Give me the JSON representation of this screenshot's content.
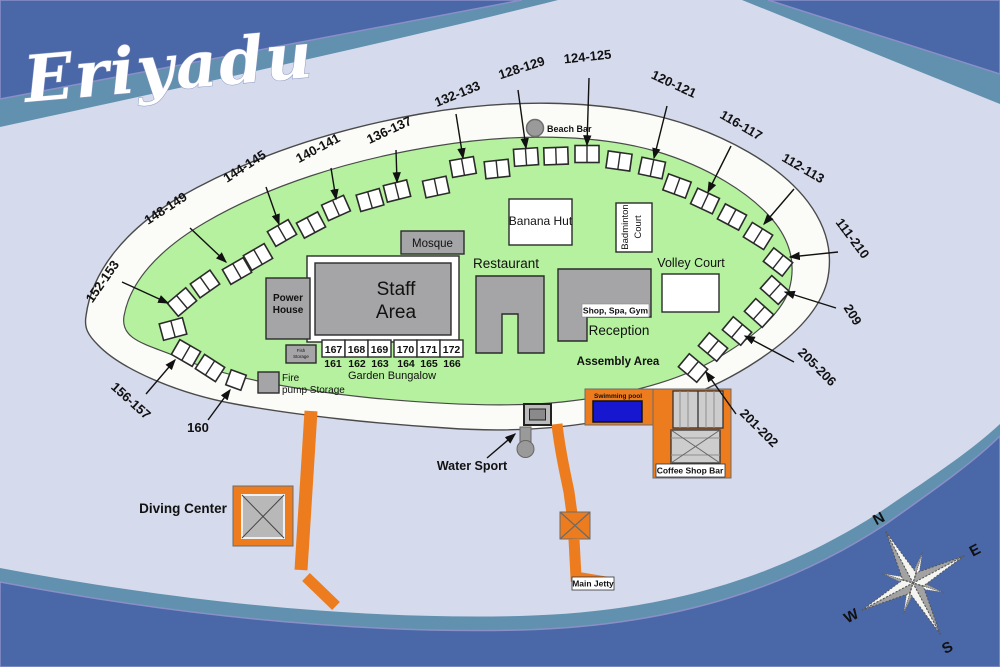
{
  "title": "Eriyadu",
  "colors": {
    "water": "#d5daec",
    "band_blue": "#4a67a8",
    "band_teal": "#6191ae",
    "island_green": "#b5f19e",
    "sand": "#fbfbf8",
    "building_gray": "#a5a4a6",
    "jetty_orange": "#ec7c1e",
    "pool_blue": "#1717cf"
  },
  "map": {
    "facilities": {
      "beach_bar": "Beach Bar",
      "mosque": "Mosque",
      "staff_area_line1": "Staff",
      "staff_area_line2": "Area",
      "power_house_line1": "Power",
      "power_house_line2": "House",
      "banana_hut": "Banana Hut",
      "badminton_line1": "Badminton",
      "badminton_line2": "Court",
      "restaurant": "Restaurant",
      "volley_court": "Volley Court",
      "shop_spa_gym": "Shop, Spa, Gym",
      "reception": "Reception",
      "assembly_area": "Assembly Area",
      "garden_bungalow": "Garden Bungalow",
      "fire_pump_line1": "Fire",
      "fire_pump_line2": "pump Storage",
      "fish_storage_line1": "Fish",
      "fish_storage_line2": "Storage",
      "swimming_pool": "Swimming pool",
      "coffee_shop_bar": "Coffee Shop Bar",
      "water_sport": "Water Sport",
      "main_jetty": "Main Jetty",
      "diving_center": "Diving Center"
    },
    "garden_rooms": {
      "top": [
        "167",
        "168",
        "169",
        "170",
        "171",
        "172"
      ],
      "bottom": [
        "161",
        "162",
        "163",
        "164",
        "165",
        "166"
      ],
      "xs": [
        322,
        345,
        368,
        394,
        417,
        440
      ],
      "bxs": [
        333,
        357,
        380,
        406,
        429,
        452
      ]
    },
    "callouts": [
      {
        "label": "148-149",
        "x": 168,
        "y": 212,
        "rot": -33,
        "x1": 190,
        "y1": 228,
        "x2": 226,
        "y2": 262
      },
      {
        "label": "144-145",
        "x": 247,
        "y": 170,
        "rot": -33,
        "x1": 266,
        "y1": 187,
        "x2": 279,
        "y2": 224
      },
      {
        "label": "140-141",
        "x": 320,
        "y": 152,
        "rot": -28,
        "x1": 331,
        "y1": 168,
        "x2": 336,
        "y2": 199
      },
      {
        "label": "136-137",
        "x": 391,
        "y": 134,
        "rot": -25,
        "x1": 396,
        "y1": 150,
        "x2": 397,
        "y2": 182
      },
      {
        "label": "132-133",
        "x": 459,
        "y": 98,
        "rot": -22,
        "x1": 456,
        "y1": 114,
        "x2": 463,
        "y2": 158
      },
      {
        "label": "128-129",
        "x": 523,
        "y": 72,
        "rot": -18,
        "x1": 518,
        "y1": 90,
        "x2": 526,
        "y2": 148
      },
      {
        "label": "124-125",
        "x": 588,
        "y": 61,
        "rot": -6,
        "x1": 589,
        "y1": 78,
        "x2": 587,
        "y2": 145
      },
      {
        "label": "120-121",
        "x": 672,
        "y": 88,
        "rot": 25,
        "x1": 667,
        "y1": 106,
        "x2": 654,
        "y2": 158
      },
      {
        "label": "116-117",
        "x": 739,
        "y": 129,
        "rot": 30,
        "x1": 731,
        "y1": 146,
        "x2": 708,
        "y2": 192
      },
      {
        "label": "112-113",
        "x": 801,
        "y": 172,
        "rot": 30,
        "x1": 794,
        "y1": 189,
        "x2": 764,
        "y2": 224
      },
      {
        "label": "111-210",
        "x": 849,
        "y": 241,
        "rot": 53,
        "x1": 838,
        "y1": 252,
        "x2": 790,
        "y2": 257
      },
      {
        "label": "209",
        "x": 849,
        "y": 317,
        "rot": 58,
        "x1": 836,
        "y1": 308,
        "x2": 785,
        "y2": 292
      },
      {
        "label": "205-206",
        "x": 814,
        "y": 370,
        "rot": 45,
        "x1": 794,
        "y1": 362,
        "x2": 745,
        "y2": 336
      },
      {
        "label": "201-202",
        "x": 756,
        "y": 431,
        "rot": 45,
        "x1": 736,
        "y1": 414,
        "x2": 706,
        "y2": 372
      },
      {
        "label": "152-153",
        "x": 106,
        "y": 284,
        "rot": -55,
        "x1": 122,
        "y1": 282,
        "x2": 168,
        "y2": 303
      },
      {
        "label": "156-157",
        "x": 128,
        "y": 404,
        "rot": 42,
        "x1": 146,
        "y1": 394,
        "x2": 175,
        "y2": 360
      },
      {
        "label": "160",
        "x": 198,
        "y": 432,
        "rot": 0,
        "x1": 208,
        "y1": 420,
        "x2": 230,
        "y2": 390
      }
    ],
    "bungalows": [
      {
        "x": 182,
        "y": 302,
        "r": -40
      },
      {
        "x": 205,
        "y": 284,
        "r": -35
      },
      {
        "x": 237,
        "y": 271,
        "r": -30
      },
      {
        "x": 258,
        "y": 257,
        "r": -30
      },
      {
        "x": 282,
        "y": 233,
        "r": -30
      },
      {
        "x": 311,
        "y": 225,
        "r": -28
      },
      {
        "x": 336,
        "y": 208,
        "r": -24
      },
      {
        "x": 370,
        "y": 200,
        "r": -16
      },
      {
        "x": 397,
        "y": 191,
        "r": -14
      },
      {
        "x": 436,
        "y": 187,
        "r": -12
      },
      {
        "x": 463,
        "y": 167,
        "r": -10
      },
      {
        "x": 497,
        "y": 169,
        "r": -6
      },
      {
        "x": 526,
        "y": 157,
        "r": -4
      },
      {
        "x": 556,
        "y": 156,
        "r": -2
      },
      {
        "x": 587,
        "y": 154,
        "r": 0
      },
      {
        "x": 619,
        "y": 161,
        "r": 8
      },
      {
        "x": 652,
        "y": 168,
        "r": 12
      },
      {
        "x": 677,
        "y": 186,
        "r": 20
      },
      {
        "x": 705,
        "y": 201,
        "r": 25
      },
      {
        "x": 732,
        "y": 217,
        "r": 28
      },
      {
        "x": 758,
        "y": 236,
        "r": 32
      },
      {
        "x": 778,
        "y": 262,
        "r": 38
      },
      {
        "x": 775,
        "y": 290,
        "r": 42
      },
      {
        "x": 759,
        "y": 313,
        "r": 42
      },
      {
        "x": 737,
        "y": 331,
        "r": 40
      },
      {
        "x": 713,
        "y": 347,
        "r": 40
      },
      {
        "x": 693,
        "y": 368,
        "r": 40
      },
      {
        "x": 173,
        "y": 329,
        "r": -15
      },
      {
        "x": 186,
        "y": 353,
        "r": 30
      },
      {
        "x": 210,
        "y": 368,
        "r": 33
      },
      {
        "x": 236,
        "y": 380,
        "r": 20,
        "single": true
      }
    ],
    "compass": {
      "n": "N",
      "e": "E",
      "s": "S",
      "w": "W"
    }
  }
}
